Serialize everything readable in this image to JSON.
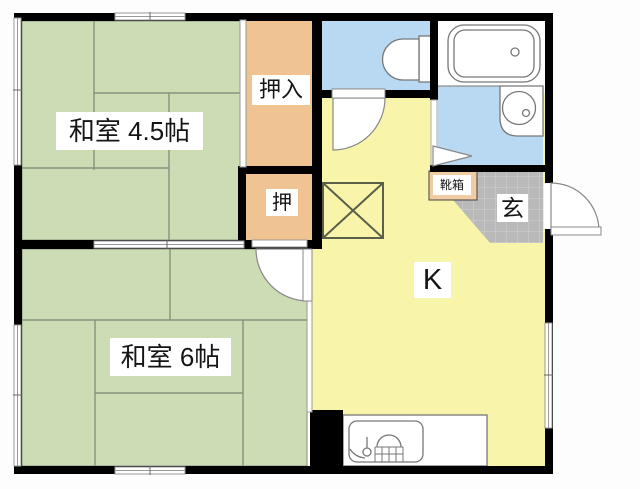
{
  "floorplan": {
    "rooms": {
      "washitsu45": {
        "label": "和室 4.5帖"
      },
      "washitsu6": {
        "label": "和室 6帖"
      },
      "kitchen": {
        "label": "K"
      },
      "oshiire": {
        "label": "押入"
      },
      "oshi": {
        "label": "押"
      },
      "genkan": {
        "label": "玄"
      },
      "shoebox": {
        "label": "靴箱"
      }
    },
    "fixtures": [
      "bathtub-icon",
      "toilet-icon",
      "wash-basin-icon",
      "kitchen-sink-icon",
      "floor-hatch-x-icon",
      "door-swing-icon",
      "folding-door-icon"
    ],
    "colors": {
      "tatami_green": "#ccdcb4",
      "tatami_line": "#85937c",
      "closet_orange": "#efc392",
      "kitchen_yellow": "#f8f5aa",
      "water_blue": "#b9d9f2",
      "genkan_gray": "#b9b9b9",
      "genkan_grid": "#d2d2d2",
      "shoebox_tan": "#f0cba3",
      "wall_black": "#000000",
      "fixture_line": "#777777"
    }
  }
}
